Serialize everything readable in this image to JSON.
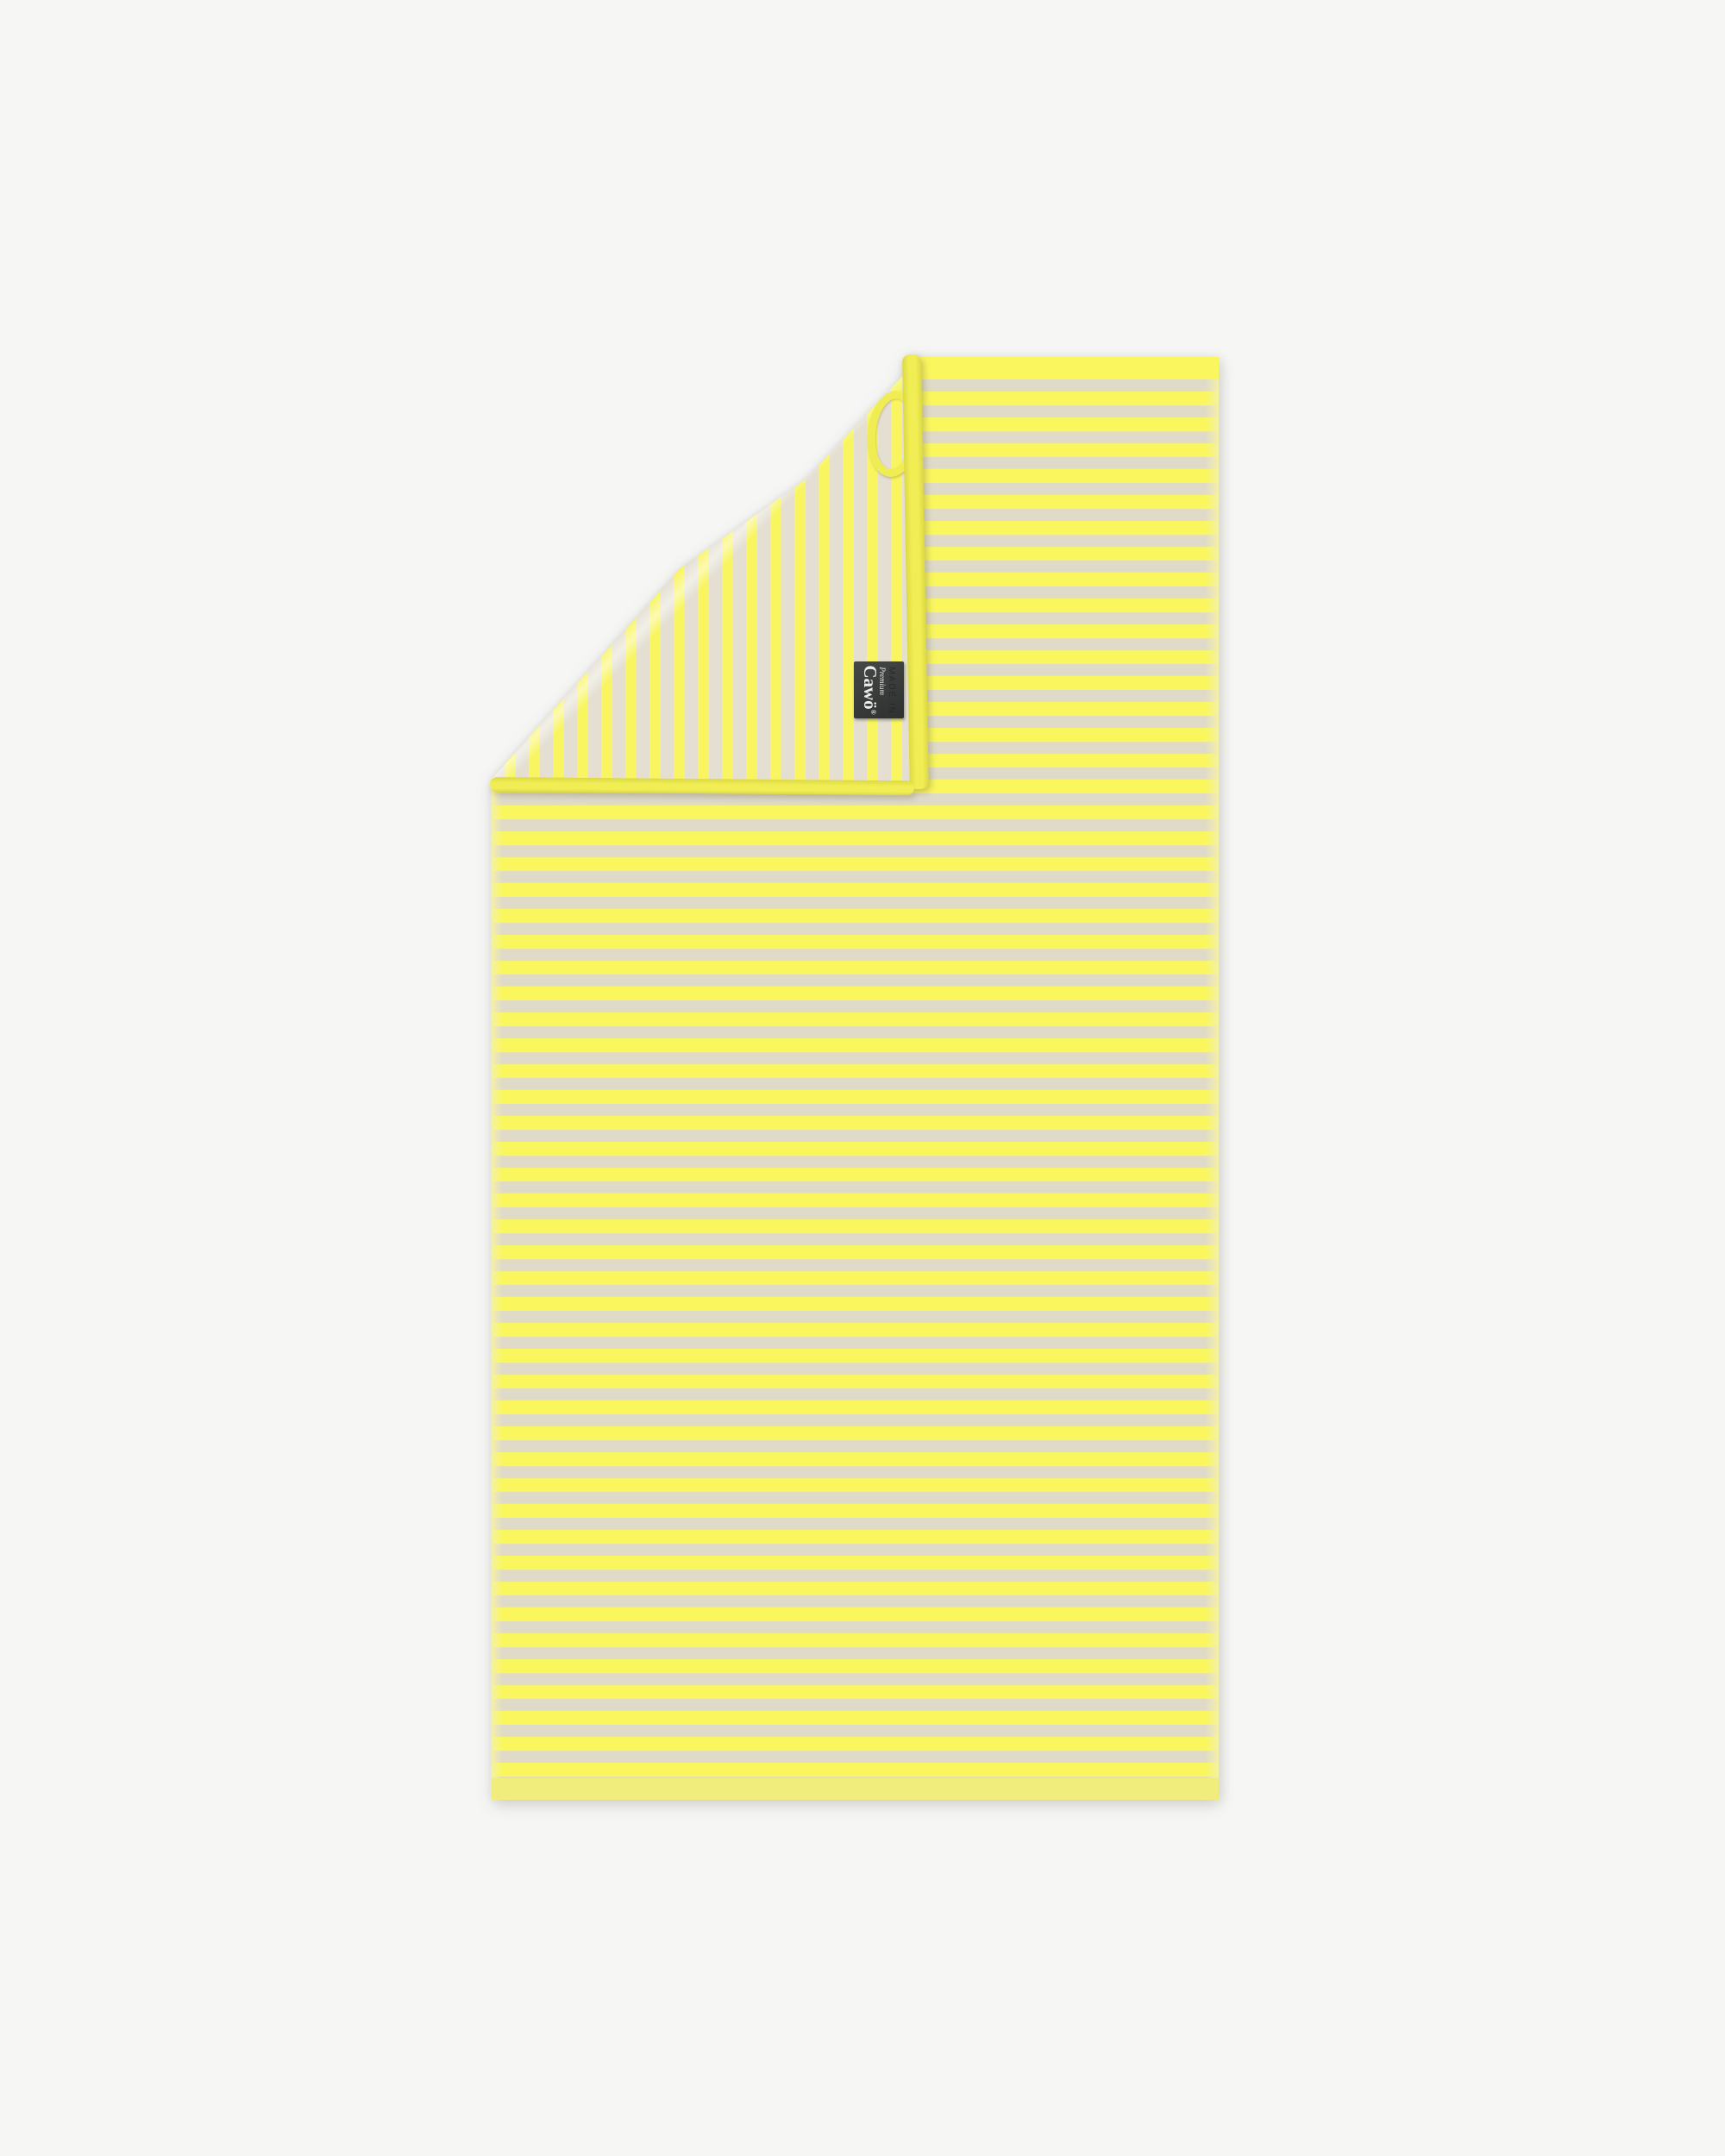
{
  "scene": {
    "description": "Product photo of a striped terry towel on a plain light background; the top-left corner is folded over showing the reverse side of the stripe weave, a yellow hanging loop and a dark woven brand label."
  },
  "towel": {
    "front_pattern": "horizontal yellow and greige stripes",
    "reverse_pattern": "vertical yellow and greige stripes",
    "edges": "yellow bound edges, solid pale yellow hem at bottom"
  },
  "label": {
    "premium_text": "Premium",
    "brand_text": "Cawö",
    "registered_mark": "®",
    "ghost_text": "MADE IN"
  },
  "colors": {
    "page_bg": "#f6f6f5",
    "front_yellow": "#faf75e",
    "front_greige": "#e0dbc9",
    "reverse_yellow": "#f8f560",
    "reverse_greige": "#e4dfd0",
    "binding_yellow": "#f1ee55",
    "binding_shade": "#dcd945",
    "hem_yellow": "#f0ed7c",
    "selvedge_yellow": "#f3f1a6",
    "label_bg_dark": "#3b3e3c",
    "label_bg_darker": "#2d302e",
    "label_text": "#edeeea",
    "label_ghost": "#242725",
    "loop_yellow": "#efec54"
  }
}
